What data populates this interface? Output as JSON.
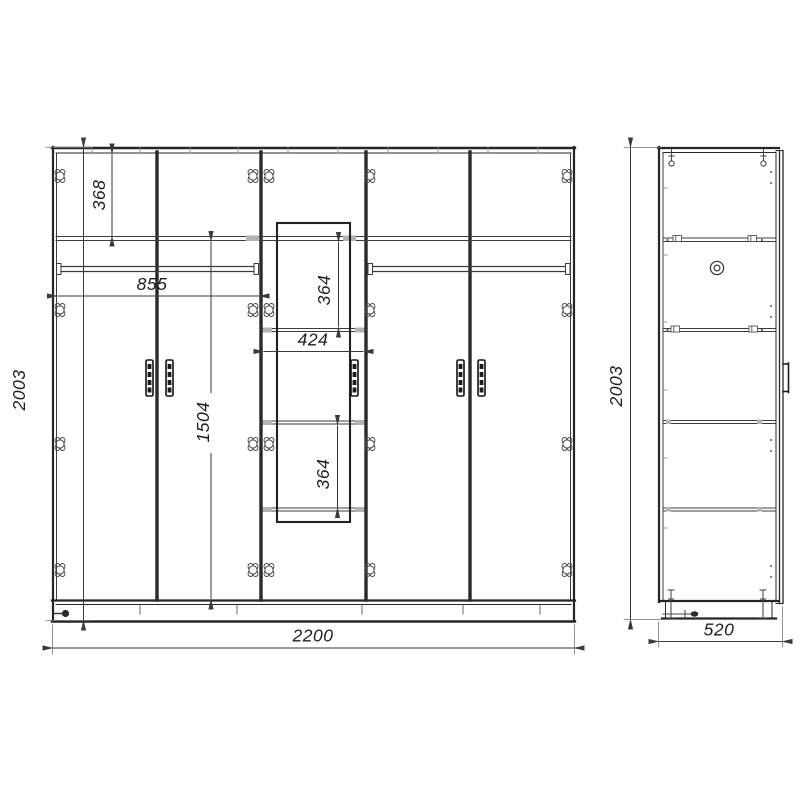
{
  "drawing_type": "wardrobe-technical-drawing",
  "colors": {
    "background": "#ffffff",
    "structure_lines": "#262626",
    "dimension_lines": "#3a3a3a",
    "light_marks": "#9a9a9a"
  },
  "front_view": {
    "door_count": 5,
    "dimensions_mm": {
      "overall_height": "2003",
      "overall_width": "2200",
      "top_shelf_from_top": "368",
      "left_section_width": "855",
      "below_shelf_height": "1504",
      "middle_upper_opening": "364",
      "middle_section_width": "424",
      "middle_lower_opening": "364"
    }
  },
  "side_view": {
    "dimensions_mm": {
      "overall_height": "2003",
      "overall_depth": "520"
    }
  }
}
